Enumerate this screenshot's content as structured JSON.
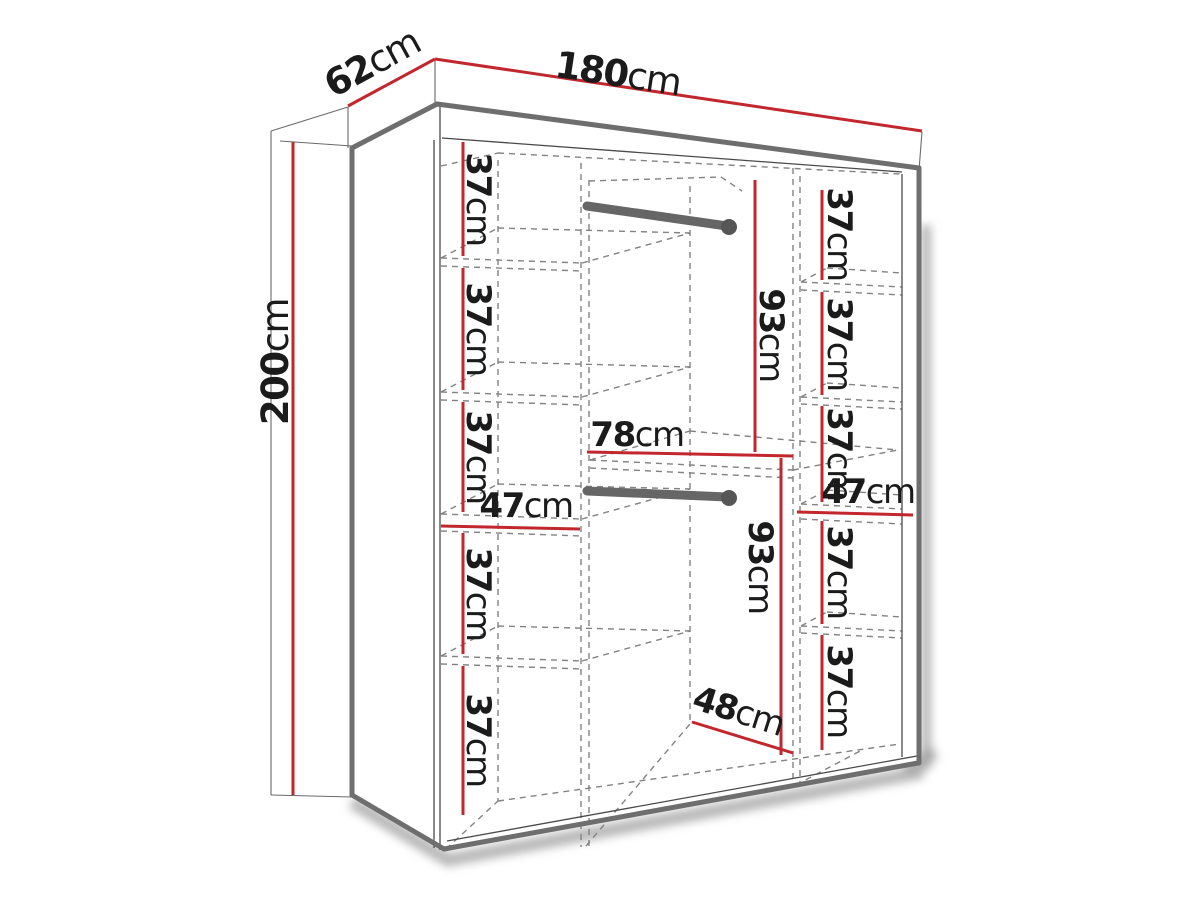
{
  "colors": {
    "dimension_red": "#c1272d",
    "outline_gray": "#6e6e6e",
    "line_dark": "#4a4a4a",
    "dashed_gray": "#828282",
    "background": "#ffffff",
    "text": "#1b1b1b"
  },
  "dims": {
    "width": {
      "num": "180",
      "unit": "cm"
    },
    "depth": {
      "num": "62",
      "unit": "cm"
    },
    "height": {
      "num": "200",
      "unit": "cm"
    },
    "left_column": {
      "gap1": {
        "num": "37",
        "unit": "cm"
      },
      "gap2": {
        "num": "37",
        "unit": "cm"
      },
      "gap3": {
        "num": "37",
        "unit": "cm"
      },
      "width": {
        "num": "47",
        "unit": "cm"
      },
      "gap4": {
        "num": "37",
        "unit": "cm"
      },
      "gap5": {
        "num": "37",
        "unit": "cm"
      }
    },
    "center_column": {
      "top_hanging": {
        "num": "93",
        "unit": "cm"
      },
      "width": {
        "num": "78",
        "unit": "cm"
      },
      "bottom_hanging": {
        "num": "93",
        "unit": "cm"
      },
      "depth": {
        "num": "48",
        "unit": "cm"
      }
    },
    "right_column": {
      "gap1": {
        "num": "37",
        "unit": "cm"
      },
      "gap2": {
        "num": "37",
        "unit": "cm"
      },
      "gap3": {
        "num": "37",
        "unit": "cm"
      },
      "width": {
        "num": "47",
        "unit": "cm"
      },
      "gap4": {
        "num": "37",
        "unit": "cm"
      },
      "gap5": {
        "num": "37",
        "unit": "cm"
      }
    }
  }
}
